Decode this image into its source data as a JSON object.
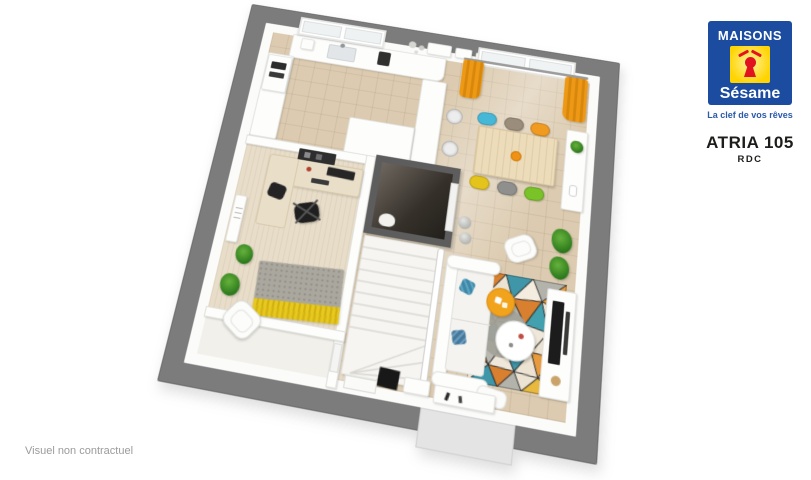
{
  "branding": {
    "name_top": "MAISONS",
    "name_bottom": "Sésame",
    "tagline": "La clef de vos rêves"
  },
  "plan_header": {
    "model": "ATRIA 105",
    "level": "RDC"
  },
  "footer": {
    "disclaimer": "Visuel non contractuel"
  },
  "colors": {
    "brand_blue": "#1b4c9f",
    "brand_yellow": "#ffd401",
    "brand_red": "#e1131f",
    "tagline_blue": "#2a5aa8",
    "title_dark": "#1d1d1b",
    "disclaimer_gray": "#9b9b9b",
    "frame_gray": "#7c7c7c",
    "floor_tile": "#dccbb0",
    "office_floor": "#e8ddc9",
    "curtain_orange": "#ee9915",
    "table_wood": "#ecdcba"
  },
  "floorplan": {
    "view": "3d-top-down-render",
    "rooms": [
      "kitchen",
      "dining-area",
      "living-area",
      "office",
      "wc",
      "staircase",
      "entry-hall",
      "garage"
    ],
    "dining_chairs": [
      {
        "seat": "top-1",
        "color": "#45b8d8"
      },
      {
        "seat": "top-2",
        "color": "#9b8d7c"
      },
      {
        "seat": "top-3",
        "color": "#f09a20"
      },
      {
        "seat": "bottom-1",
        "color": "#e4c31a"
      },
      {
        "seat": "bottom-2",
        "color": "#8f8f8d"
      },
      {
        "seat": "bottom-3",
        "color": "#79c228"
      }
    ]
  }
}
